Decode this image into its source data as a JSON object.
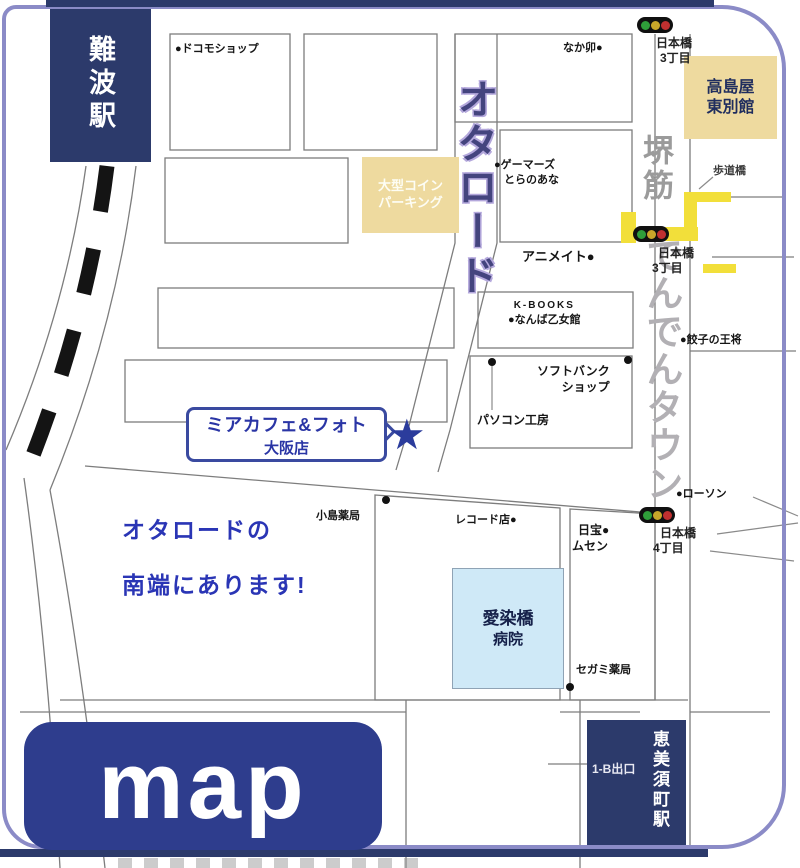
{
  "frame": {
    "logo": "map"
  },
  "stations": {
    "namba": "難波駅",
    "ebisucho": "恵美須町駅",
    "ebisucho_exit": "1-B出口"
  },
  "streets": {
    "ota_road": "オタロード",
    "sakaisuji": "堺筋",
    "denden_town": "でんでんタウン"
  },
  "districts": {
    "nihonbashi3_top": {
      "l1": "日本橋",
      "l2": "3丁目"
    },
    "nihonbashi3_mid": {
      "l1": "日本橋",
      "l2": "3丁目"
    },
    "nihonbashi4": {
      "l1": "日本橋",
      "l2": "4丁目"
    },
    "pedestrian_bridge": "歩道橋"
  },
  "buildings": {
    "takashimaya": {
      "l1": "高島屋",
      "l2": "東別館"
    },
    "parking": {
      "l1": "大型コイン",
      "l2": "パーキング"
    },
    "hospital": {
      "l1": "愛染橋",
      "l2": "病院"
    }
  },
  "pois": {
    "docomo": "●ドコモショップ",
    "nakau": "なか卯●",
    "gamers": {
      "l1": "●ゲーマーズ",
      "l2": "とらのあな"
    },
    "animate": "アニメイト●",
    "kbooks": {
      "l1": "K-BOOKS",
      "l2": "●なんば乙女館"
    },
    "softbank": {
      "l1": "ソフトバンク",
      "l2": "ショップ"
    },
    "pckobo": "パソコン工房",
    "kojima": "小島薬局",
    "record": "レコード店●",
    "nippo": {
      "l1": "日宝●",
      "l2": "ムセン"
    },
    "lawson": "●ローソン",
    "gyoza": "●餃子の王将",
    "segami": "セガミ薬局"
  },
  "shop_callout": {
    "l1": "ミアカフェ&フォト",
    "l2": "大阪店",
    "star": "★"
  },
  "note": {
    "l1": "オタロードの",
    "l2": "南端にあります!"
  },
  "colors": {
    "navy": "#2c3a6b",
    "logo_navy": "#2e3d8d",
    "tan": "#eeda9f",
    "light_blue": "#cfe9f7",
    "frame_purple": "#8b8bc7",
    "bridge_yellow": "#f2df3a",
    "note_blue": "#2a35b5",
    "ota_purple": "#44447e"
  }
}
